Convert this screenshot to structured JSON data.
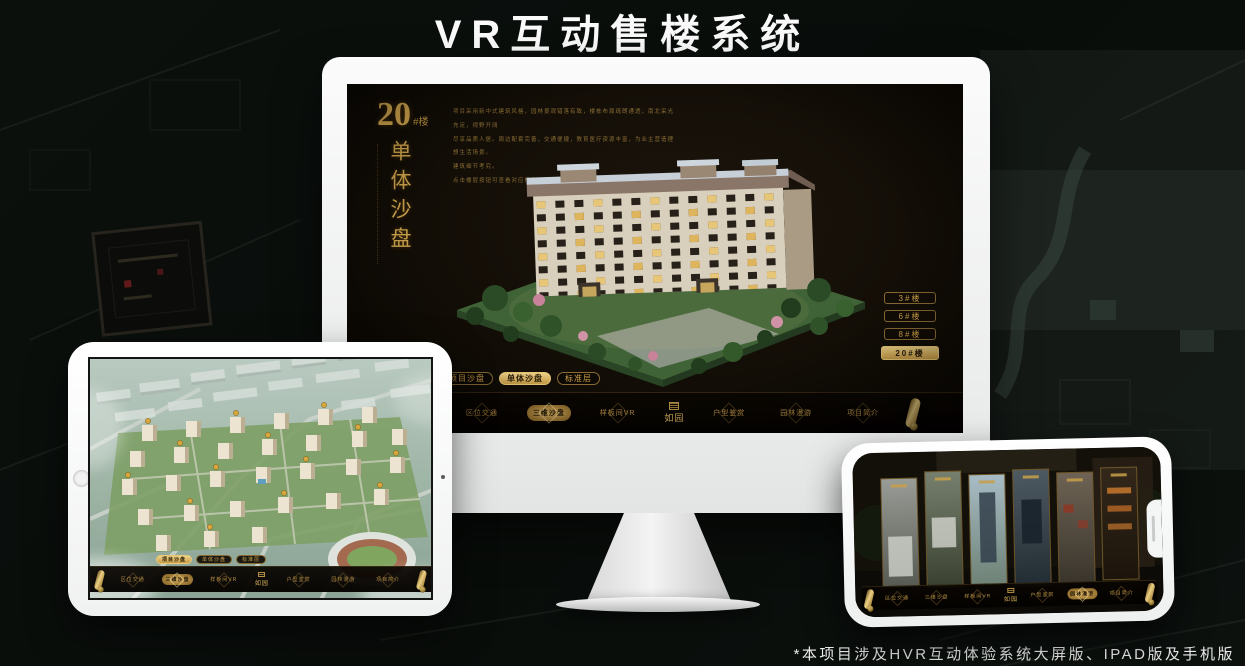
{
  "page": {
    "title": "VR互动售楼系统",
    "footnote": "*本项目涉及HVR互动体验系统大屏版、IPAD版及手机版"
  },
  "colors": {
    "accent_gold": "#d2a74e",
    "active_pill_bg": "#d8ac55",
    "screen_bg": "#151008",
    "page_bg": "#0a0f0c"
  },
  "desktop_app": {
    "heading_number": "20",
    "heading_suffix": "#楼",
    "heading_vertical": "单体沙盘",
    "description_lines": [
      "项目采用新中式建筑风格，园林景观错落有致，楼栋布局疏朗通透，南北采光充足，视野开阔",
      "尽享品质人居。周边配套完善，交通便捷，教育医疗资源丰富，为业主营造理想生活场景。",
      "建筑细节考究。",
      "点击楼层按钮可查看对应楼栋与标准层详情。"
    ],
    "floor_buttons": [
      {
        "label": "3#楼"
      },
      {
        "label": "6#楼"
      },
      {
        "label": "8#楼"
      },
      {
        "label": "20#楼",
        "active": true
      }
    ],
    "mode_tabs": [
      {
        "label": "项目沙盘"
      },
      {
        "label": "单体沙盘",
        "active": true
      },
      {
        "label": "标准层"
      }
    ],
    "nav": {
      "logo": "如园",
      "items": [
        {
          "label": "区位交通"
        },
        {
          "label": "三维沙盘",
          "active": true
        },
        {
          "label": "样板间VR"
        },
        {
          "label": "户型鉴赏"
        },
        {
          "label": "园林漫游"
        },
        {
          "label": "项目简介"
        }
      ]
    }
  },
  "ipad_app": {
    "mode_tabs": [
      {
        "label": "项目沙盘",
        "active": true
      },
      {
        "label": "单体沙盘"
      },
      {
        "label": "标准层"
      }
    ],
    "nav": {
      "logo": "如园",
      "items": [
        {
          "label": "区位交通"
        },
        {
          "label": "三维沙盘",
          "active": true
        },
        {
          "label": "样板间VR"
        },
        {
          "label": "户型鉴赏"
        },
        {
          "label": "园林漫游"
        },
        {
          "label": "项目简介"
        }
      ]
    }
  },
  "phone_app": {
    "nav": {
      "logo": "如园",
      "items": [
        {
          "label": "区位交通"
        },
        {
          "label": "三维沙盘"
        },
        {
          "label": "样板间VR"
        },
        {
          "label": "户型鉴赏"
        },
        {
          "label": "园林漫游",
          "active": true
        },
        {
          "label": "项目简介"
        }
      ]
    }
  }
}
